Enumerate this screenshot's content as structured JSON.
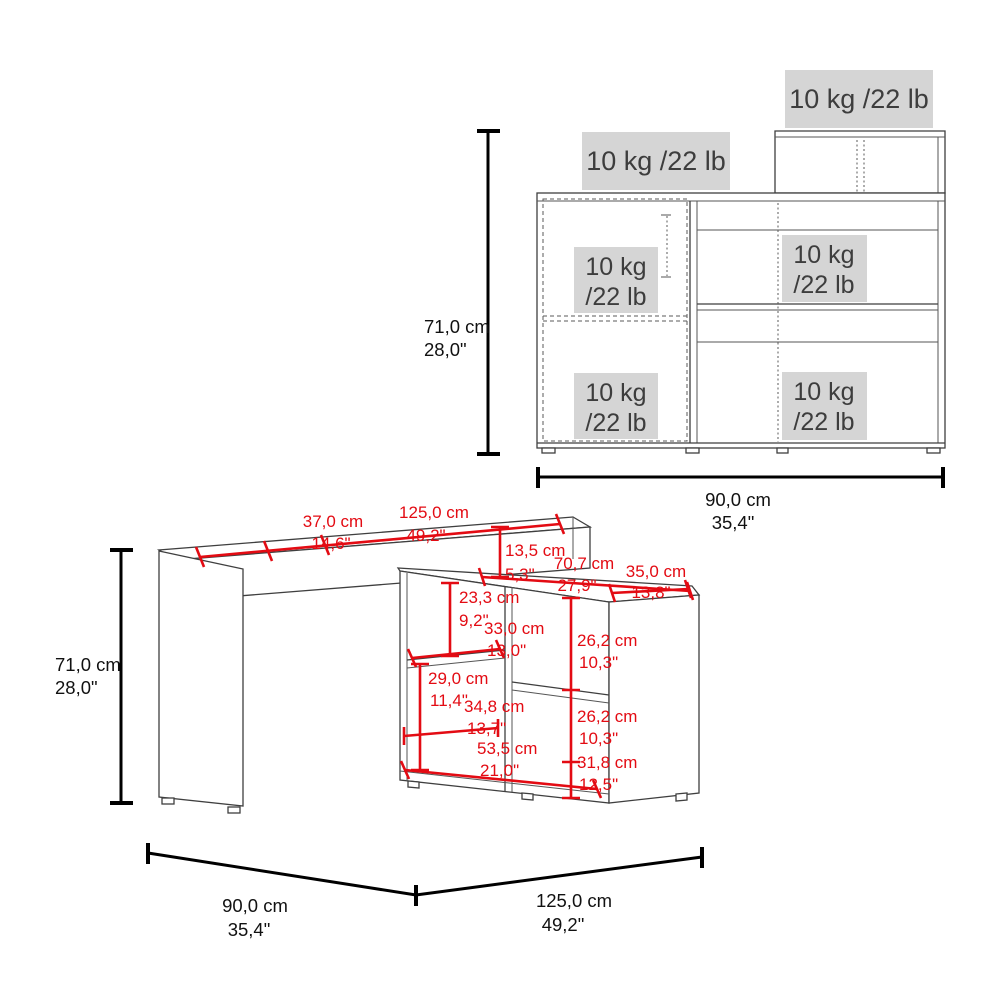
{
  "colors": {
    "dimension_red": "#e30b13",
    "dimension_black": "#111111",
    "furniture_line": "#3f3f3f",
    "weight_box_bg": "#d5d5d5",
    "weight_text": "#3d3d3d",
    "background": "#ffffff"
  },
  "cabinet_view": {
    "weight_top_right": "10 kg /22 lb",
    "weight_top_left": "10 kg /22 lb",
    "compartments": [
      {
        "top": "10 kg",
        "bottom": "/22 lb"
      },
      {
        "top": "10 kg",
        "bottom": "/22 lb"
      },
      {
        "top": "10 kg",
        "bottom": "/22 lb"
      },
      {
        "top": "10 kg",
        "bottom": "/22 lb"
      }
    ],
    "height": {
      "cm": "71,0 cm",
      "inches": "28,0\""
    },
    "width": {
      "cm": "90,0 cm",
      "inches": "35,4\""
    }
  },
  "desk_view": {
    "height": {
      "cm": "71,0 cm",
      "inches": "28,0\""
    },
    "footprint_left": {
      "cm": "90,0 cm",
      "inches": "35,4\""
    },
    "footprint_right": {
      "cm": "125,0 cm",
      "inches": "49,2\""
    },
    "dimensions": {
      "desktop_overhang": {
        "cm": "37,0 cm",
        "inches": "14,6\""
      },
      "desktop_length": {
        "cm": "125,0 cm",
        "inches": "49,2\""
      },
      "desktop_drop": {
        "cm": "13,5 cm",
        "inches": "5,3\""
      },
      "return_length": {
        "cm": "70,7 cm",
        "inches": "27,9\""
      },
      "return_depth": {
        "cm": "35,0 cm",
        "inches": "13,8\""
      },
      "upper_cubby_height": {
        "cm": "23,3 cm",
        "inches": "9,2\""
      },
      "shelf_width": {
        "cm": "33,0 cm",
        "inches": "13,0\""
      },
      "right_upper_opening": {
        "cm": "26,2 cm",
        "inches": "10,3\""
      },
      "lower_left_opening": {
        "cm": "29,0 cm",
        "inches": "11,4\""
      },
      "lower_opening_width": {
        "cm": "34,8 cm",
        "inches": "13,7\""
      },
      "right_lower_opening": {
        "cm": "26,2 cm",
        "inches": "10,3\""
      },
      "base_width": {
        "cm": "53,5 cm",
        "inches": "21,0\""
      },
      "right_bottom_opening": {
        "cm": "31,8 cm",
        "inches": "12,5\""
      }
    }
  }
}
